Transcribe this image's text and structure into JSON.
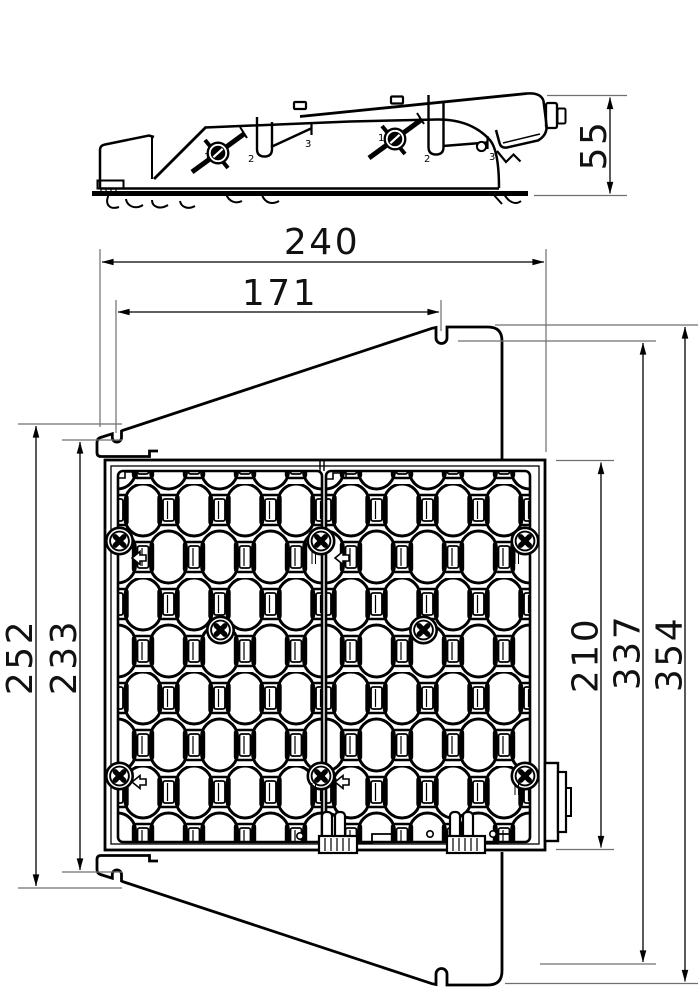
{
  "dimensions": {
    "overall_width": "240",
    "notch_spacing": "171",
    "profile_height": "55",
    "hook_outer_height": "252",
    "hook_inner_height": "233",
    "body_height": "210",
    "flap_notch_height": "337",
    "overall_height": "354"
  },
  "callouts": {
    "knob": "1",
    "hook": "2",
    "arm": "3"
  },
  "colors": {
    "line": "#000000",
    "extension_line": "#6f6f6f",
    "dim_text": "#111111",
    "background": "#ffffff"
  }
}
